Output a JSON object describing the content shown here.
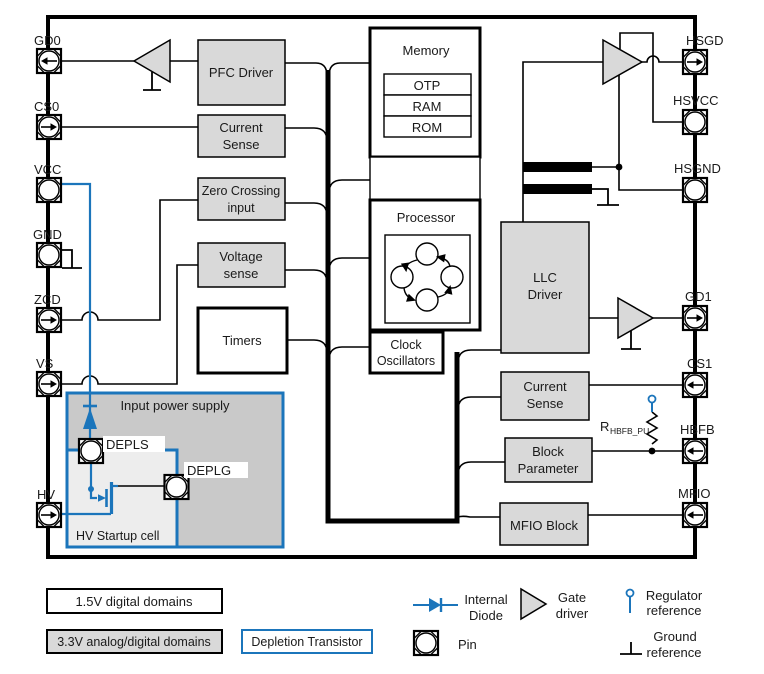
{
  "pins": {
    "left": [
      "GD0",
      "CS0",
      "VCC",
      "GND",
      "ZCD",
      "VS",
      "HV"
    ],
    "right": [
      "HSGD",
      "HSVCC",
      "HSGND",
      "GD1",
      "CS1",
      "HBFB",
      "MFIO"
    ]
  },
  "blocks": {
    "pfc_driver": "PFC Driver",
    "current_sense_l1": "Current",
    "current_sense_l2": "Sense",
    "zero_crossing_1": "Zero Crossing",
    "zero_crossing_2": "input",
    "voltage_sense_1": "Voltage",
    "voltage_sense_2": "sense",
    "timers": "Timers",
    "memory": "Memory",
    "otp": "OTP",
    "ram": "RAM",
    "rom": "ROM",
    "processor": "Processor",
    "clock_osc_1": "Clock",
    "clock_osc_2": "Oscillators",
    "llc_1": "LLC",
    "llc_2": "Driver",
    "current_sense_r1": "Current",
    "current_sense_r2": "Sense",
    "block_param_1": "Block",
    "block_param_2": "Parameter",
    "mfio_block": "MFIO Block",
    "input_power_supply": "Input power supply",
    "hv_startup_cell": "HV Startup cell",
    "depls": "DEPLS",
    "deplg": "DEPLG"
  },
  "resistor": {
    "name": "R",
    "sub": "HBFB_PU"
  },
  "legend": {
    "domain_15": "1.5V digital domains",
    "domain_33": "3.3V analog/digital domains",
    "depletion": "Depletion Transistor",
    "internal_diode_1": "Internal",
    "internal_diode_2": "Diode",
    "gate_driver_1": "Gate",
    "gate_driver_2": "driver",
    "pin": "Pin",
    "regulator_1": "Regulator",
    "regulator_2": "reference",
    "ground_1": "Ground",
    "ground_2": "reference"
  },
  "colors": {
    "blue": "#1b75bb",
    "block_gray": "#d9d9d9",
    "supply_gray": "#c9c9c9",
    "startup_gray": "#ededed"
  }
}
